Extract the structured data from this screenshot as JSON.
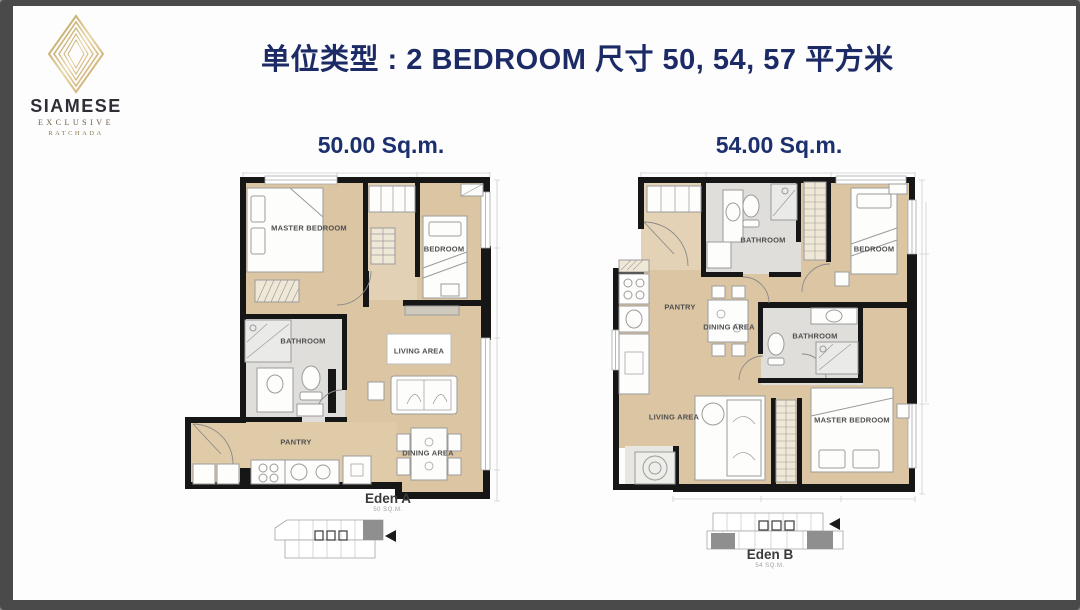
{
  "logo": {
    "brand": "SIAMESE",
    "line1": "EXCLUSIVE",
    "line2": "RATCHADA"
  },
  "header": {
    "title": "单位类型 : 2 BEDROOM 尺寸 50, 54, 57 平方米"
  },
  "plan_a": {
    "size_label": "50.00 Sq.m.",
    "unit_name": "Eden A",
    "unit_area": "50 SQ.M.",
    "rooms": {
      "master_bedroom": "MASTER BEDROOM",
      "bedroom": "BEDROOM",
      "bathroom": "BATHROOM",
      "living_area": "LIVING AREA",
      "pantry": "PANTRY",
      "dining_area": "DINING AREA"
    }
  },
  "plan_b": {
    "size_label": "54.00 Sq.m.",
    "unit_name": "Eden B",
    "unit_area": "54 SQ.M.",
    "rooms": {
      "bathroom_top": "BATHROOM",
      "bedroom": "BEDROOM",
      "pantry": "PANTRY",
      "dining_area": "DINING AREA",
      "bathroom_mid": "BATHROOM",
      "living_area": "LIVING AREA",
      "master_bedroom": "MASTER BEDROOM"
    }
  },
  "colors": {
    "title_navy": "#1c2b66",
    "floor_tan": "#dcc5a3",
    "bathroom_gray": "#dfdedb",
    "wall_black": "#161616",
    "logo_gold": "#c7a560",
    "keyplan_highlight": "#8f8f8f"
  }
}
